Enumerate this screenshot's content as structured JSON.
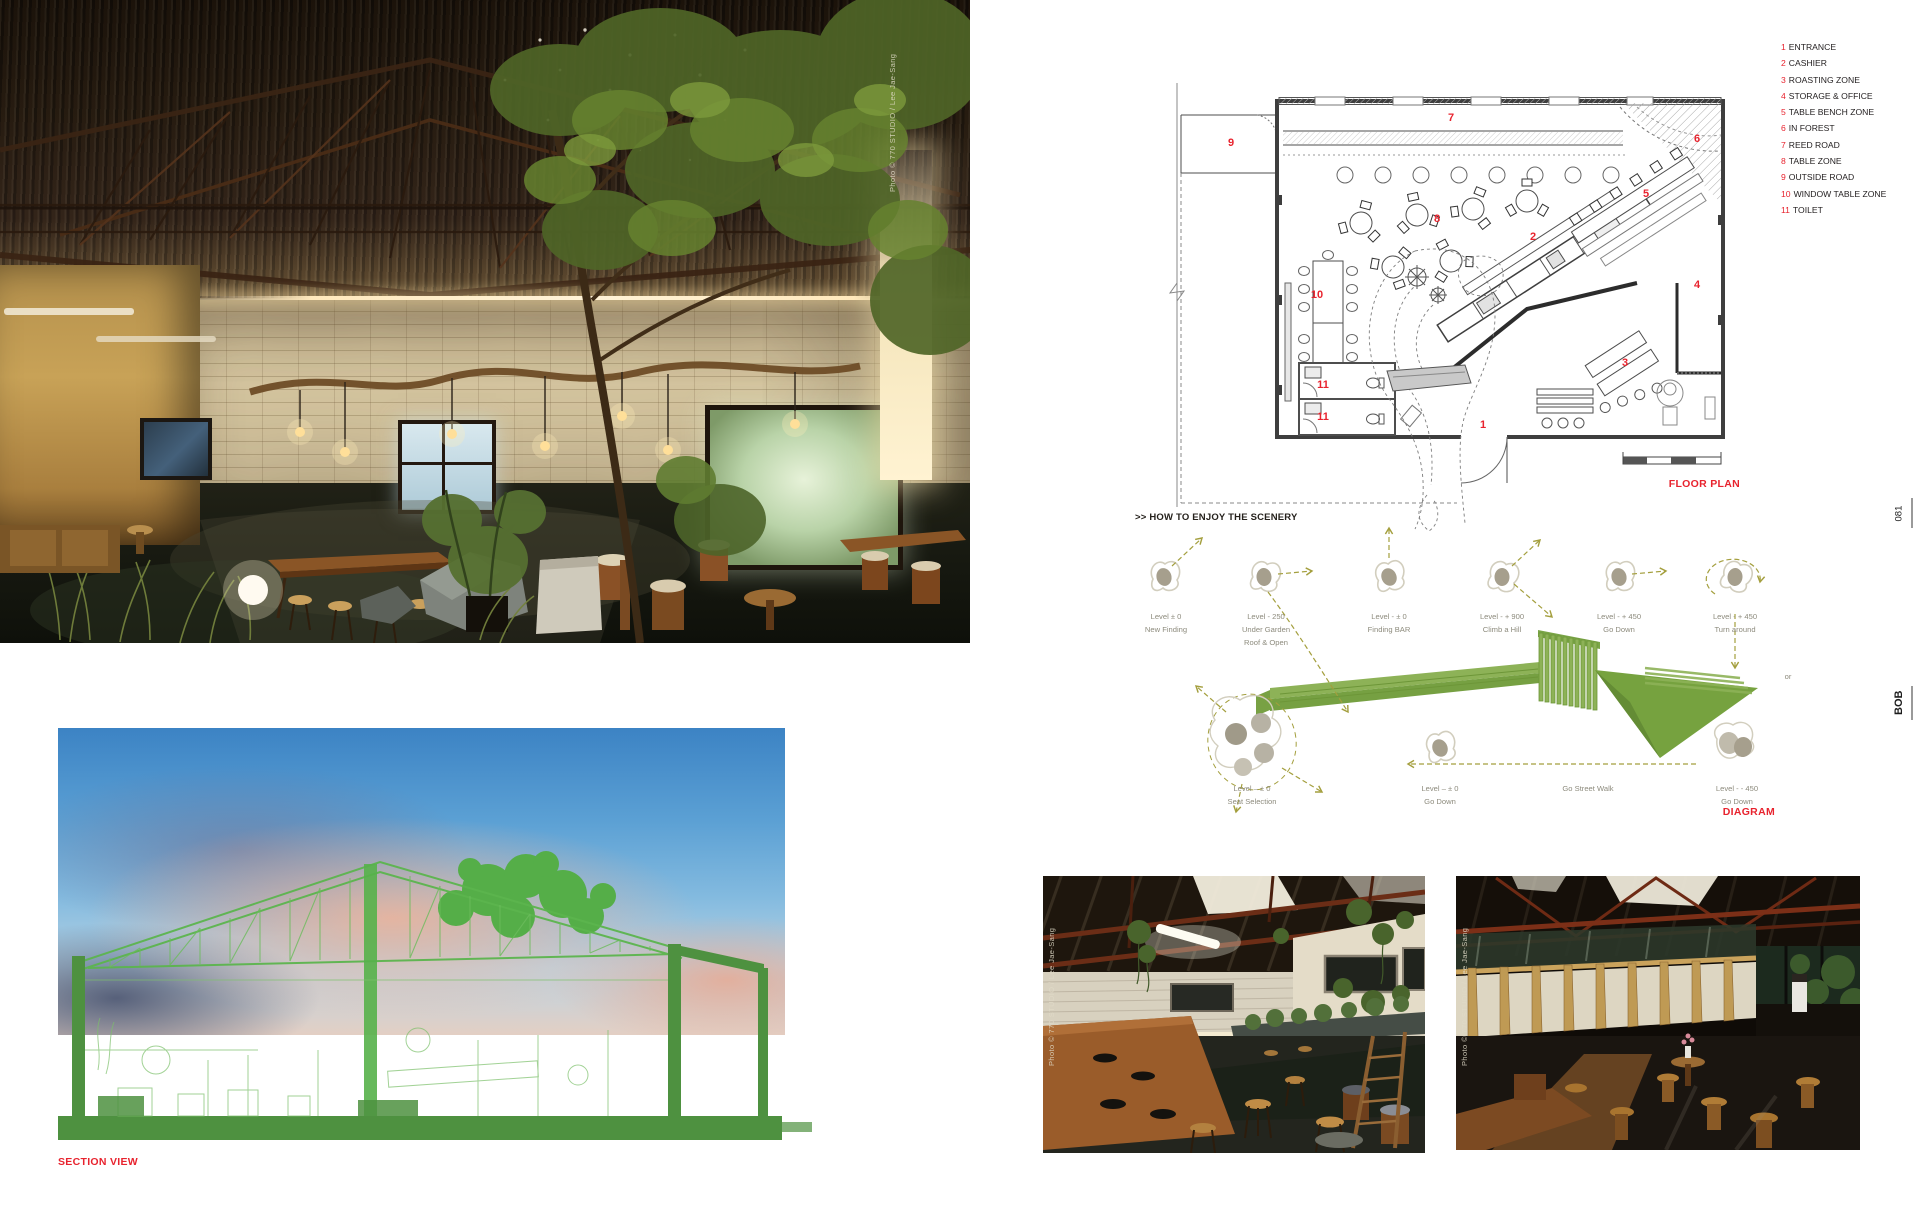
{
  "page": {
    "page_number": "081",
    "magazine": "BOB"
  },
  "photos": {
    "main": {
      "credit": "Photo © 770 STUDIO / Lee Jae-Sang"
    },
    "bottom_right_1": {
      "credit": "Photo © 770 STUDIO / Lee Jae-Sang"
    },
    "bottom_right_2": {
      "credit": "Photo © 770 STUDIO / Lee Jae-Sang"
    }
  },
  "section_view": {
    "label": "SECTION VIEW"
  },
  "floor_plan": {
    "label": "FLOOR PLAN",
    "legend": [
      {
        "num": "1",
        "label": "ENTRANCE"
      },
      {
        "num": "2",
        "label": "CASHIER"
      },
      {
        "num": "3",
        "label": "ROASTING ZONE"
      },
      {
        "num": "4",
        "label": "STORAGE & OFFICE"
      },
      {
        "num": "5",
        "label": "TABLE BENCH ZONE"
      },
      {
        "num": "6",
        "label": "IN FOREST"
      },
      {
        "num": "7",
        "label": "REED ROAD"
      },
      {
        "num": "8",
        "label": "TABLE ZONE"
      },
      {
        "num": "9",
        "label": "OUTSIDE ROAD"
      },
      {
        "num": "10",
        "label": "WINDOW TABLE ZONE"
      },
      {
        "num": "11",
        "label": "TOILET"
      }
    ],
    "markers": [
      "9",
      "7",
      "6",
      "5",
      "8",
      "2",
      "10",
      "4",
      "3",
      "1",
      "11",
      "11"
    ]
  },
  "diagram": {
    "header": ">> HOW TO ENJOY THE SCENERY",
    "label": "DIAGRAM",
    "connector": "or",
    "row1": [
      {
        "lines": [
          "Level ± 0",
          "New Finding"
        ]
      },
      {
        "lines": [
          "Level - 250",
          "Under Garden",
          "Roof & Open"
        ]
      },
      {
        "lines": [
          "Level - ± 0",
          "Finding BAR"
        ]
      },
      {
        "lines": [
          "Level - + 900",
          "Climb a Hill"
        ]
      },
      {
        "lines": [
          "Level - + 450",
          "Go Down"
        ]
      },
      {
        "lines": [
          "Level - + 450",
          "Turn around"
        ]
      }
    ],
    "row2": [
      {
        "lines": [
          "Level – ± 0",
          "Seat Selection"
        ]
      },
      {
        "lines": [
          "Level – ± 0",
          "Go Down"
        ]
      },
      {
        "lines": [
          "Go Street Walk"
        ]
      },
      {
        "lines": [
          "Level - - 450",
          "Go Down"
        ]
      }
    ]
  },
  "colors": {
    "accent_red": "#e8232e",
    "diagram_green": "#85ab4c",
    "section_green": "#4fae46",
    "arrow_olive": "#a49f3e"
  }
}
